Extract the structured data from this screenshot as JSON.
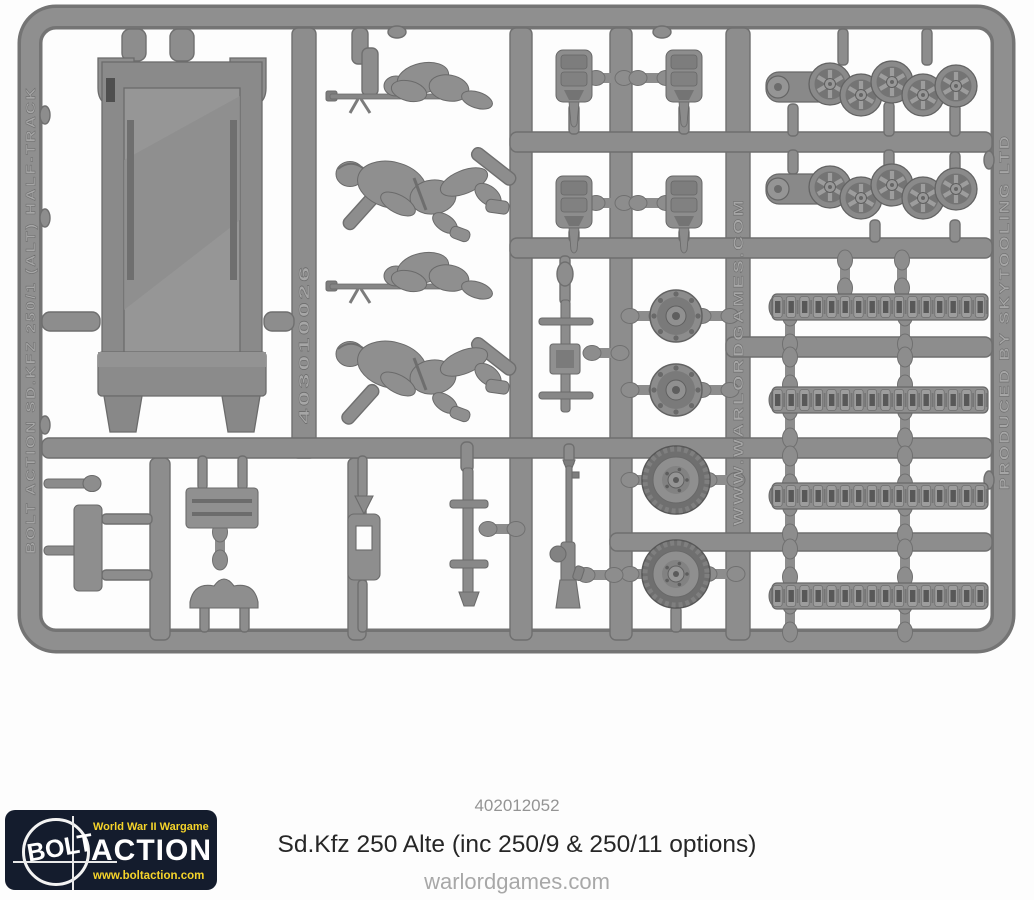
{
  "colors": {
    "background": "#fdfdfd",
    "sprue_gray": "#8d8d8d",
    "sprue_edge": "#6f6f6f",
    "sprue_light": "#a3a3a3",
    "emboss_text": "#a8a8a8",
    "logo_navy": "#141c2d",
    "logo_yellow": "#f6d42a",
    "logo_white": "#ffffff",
    "footer_code_gray": "#949494",
    "footer_title_dark": "#262626",
    "footer_site_gray": "#a8a8a8"
  },
  "sprue": {
    "markings": {
      "left": "BOLT ACTION SD.KFZ 250/1 (ALT) HALF-TRACK",
      "inner_part_number": "403010026",
      "website": "WWW.WARLORDGAMES.COM",
      "producer": "PRODUCED BY SKYTOOLING LTD"
    },
    "parts": [
      "lower-hull-tub",
      "mg-gunner-figure x2",
      "crew-figure x2",
      "suspension-mount x4",
      "road-wheel-cluster x2",
      "drive-sprocket x2",
      "front-tire x2",
      "track-length x4",
      "stowage-panel",
      "seat",
      "side-plate",
      "tool-pin x2",
      "steering-linkage",
      "mg34-machine-gun",
      "mg-pedestal-mount",
      "shield-clamp"
    ]
  },
  "footer": {
    "product_code": "402012052",
    "product_title": "Sd.Kfz 250 Alte (inc 250/9 & 250/11 options)",
    "website": "warlordgames.com"
  },
  "logo": {
    "tagline": "World War II Wargame",
    "brand_word_1": "BOLT",
    "brand_word_2": "ACTION",
    "url": "www.boltaction.com"
  }
}
